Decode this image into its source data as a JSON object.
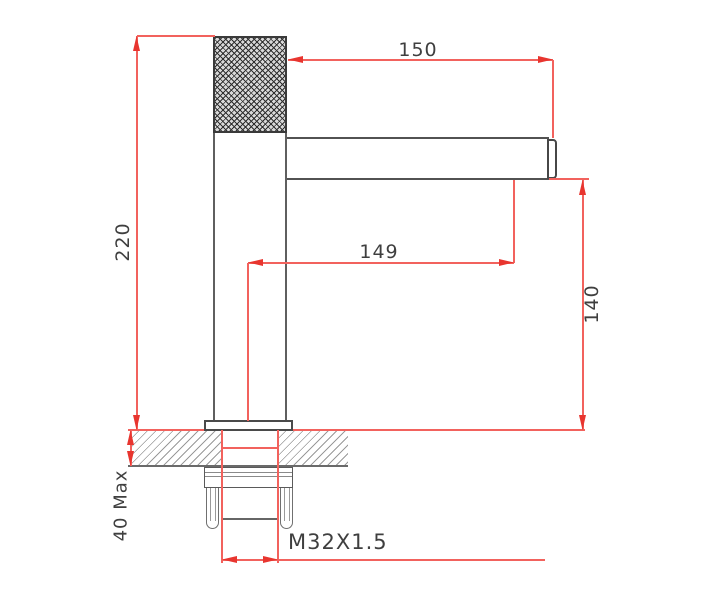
{
  "drawing": {
    "type": "technical-dimension-drawing",
    "subject": "single-handle basin faucet, side elevation with installation section",
    "dimensions": {
      "overall_height": "220",
      "spout_length_top": "150",
      "spout_reach_center": "149",
      "spout_height": "140",
      "deck_thickness": "40 Max",
      "shank_thread": "M32X1.5"
    },
    "colors": {
      "dimension_line": "#f2625d",
      "arrowhead": "#e8352f",
      "outline_gray": "#5a5a5a",
      "label_text": "#3f3f3f",
      "background": "#ffffff"
    }
  }
}
